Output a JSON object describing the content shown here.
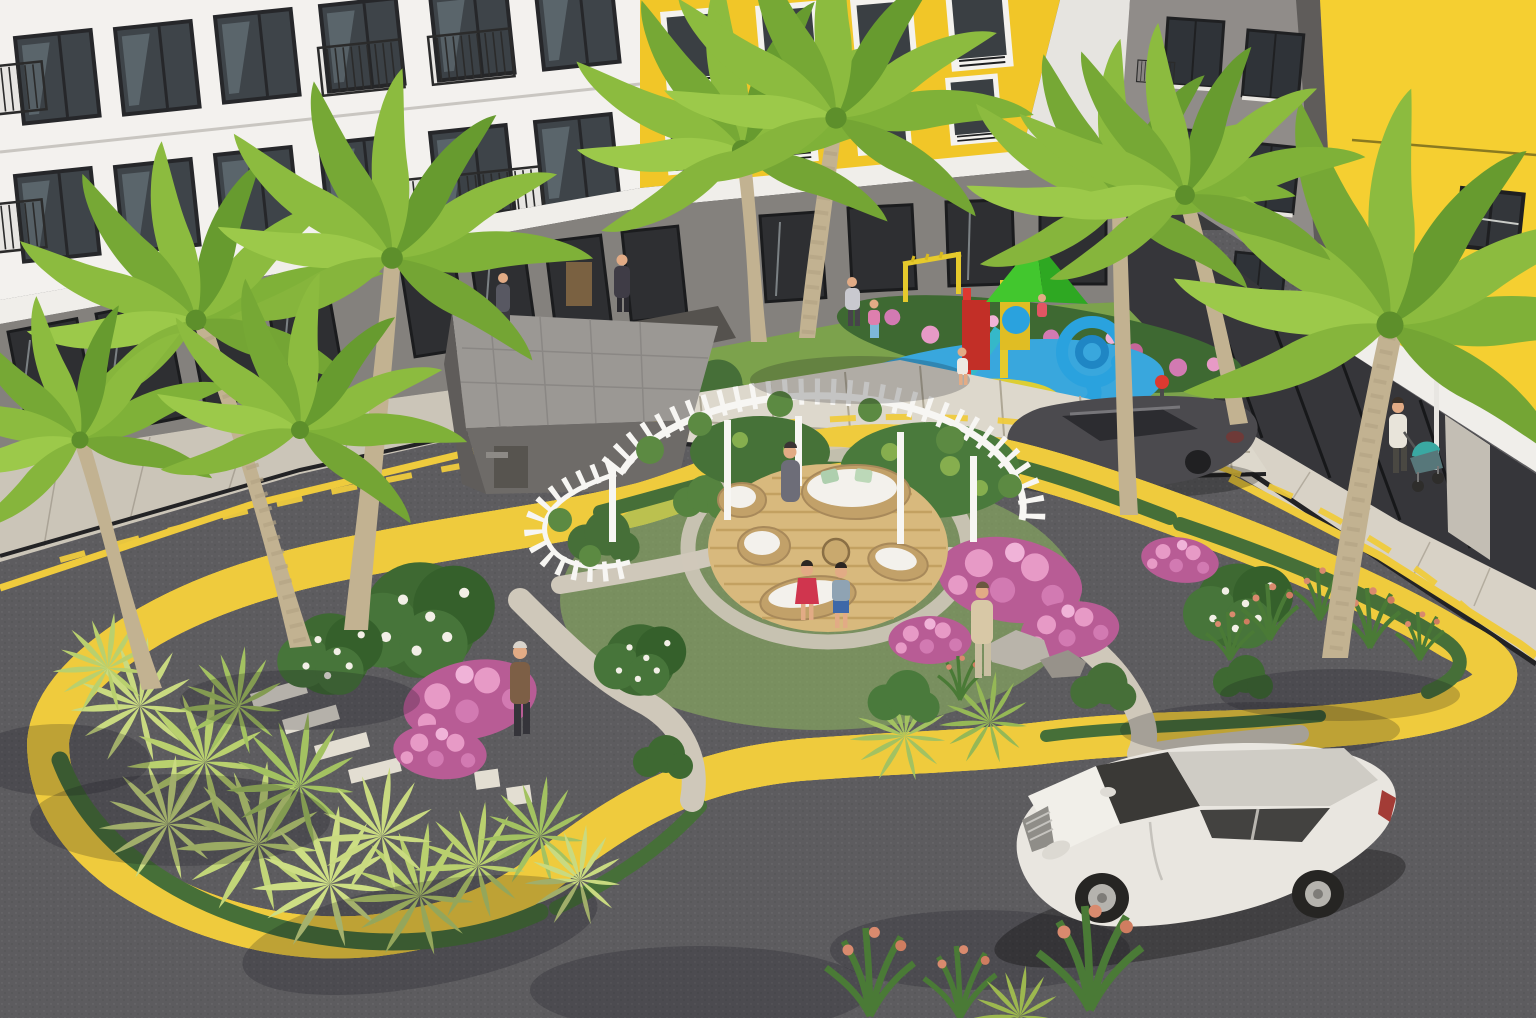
{
  "scene": {
    "title": "Aerial 3D rendering of a residential complex courtyard: palm garden island with white pergola lounge, children playground, ring road with yellow markings, white SUV and gray sedan",
    "objects": [
      "white apartment building with balconies",
      "yellow apartment block sections",
      "ground-floor storefronts",
      "landscaped traffic island",
      "white circular pergola with wicker daybeds",
      "wooden round deck",
      "children playground with green roof and blue spiral slide",
      "palm trees",
      "pink flowering shrubs",
      "white SUV",
      "dark gray sedan",
      "pedestrians and stroller",
      "asphalt ring road with yellow edge lines and dashed center line"
    ]
  },
  "colors": {
    "asphalt": "#5d5c5f",
    "curb": "#d5d0c6",
    "road_yellow": "#efcb3d",
    "sidewalk": "#cbc5b8",
    "sidewalk_right": "#d8d2c6",
    "facade_white": "#f3f1ee",
    "facade_shade": "#e6e4e0",
    "facade_yellow": "#f1c628",
    "yellow_wall": "#f5cf31",
    "facade_gray": "#908c89",
    "ground_wall": "#84817d",
    "storefront": "#2e2f32",
    "window_glass": "#3e4449",
    "frame_dark": "#26272a",
    "canopy": "#f0eeea",
    "grass": "#7ca24c",
    "grass_light": "#90ba5e",
    "hedge": "#466f38",
    "shrub_light": "#c9da80",
    "shrub_mid": "#a3c261",
    "leaf_dark": "#3e6932",
    "flower_pink": "#c56699",
    "flower_pink_light": "#e79ac6",
    "gravel": "#cfc8ba",
    "stone": "#ddd8cc",
    "deck_wood": "#d8b97d",
    "wicker": "#c2a169",
    "cushion": "#f3f1ec",
    "pergola": "#f7f6f3",
    "mat_blue": "#39a7dd",
    "mat_yellow": "#ddce34",
    "mat_purple": "#9159b8",
    "play_green": "#42c72e",
    "play_red": "#dd3930",
    "play_blue": "#2aa2de",
    "play_yellow": "#e6ca2c",
    "suv_body": "#e9e6e0",
    "suv_roof": "#cfccc5",
    "suv_glass": "#3a3936",
    "sedan_body": "#4b4a4e",
    "palm_trunk": "#c2b291",
    "palm_frond": "#8cbb3f"
  }
}
